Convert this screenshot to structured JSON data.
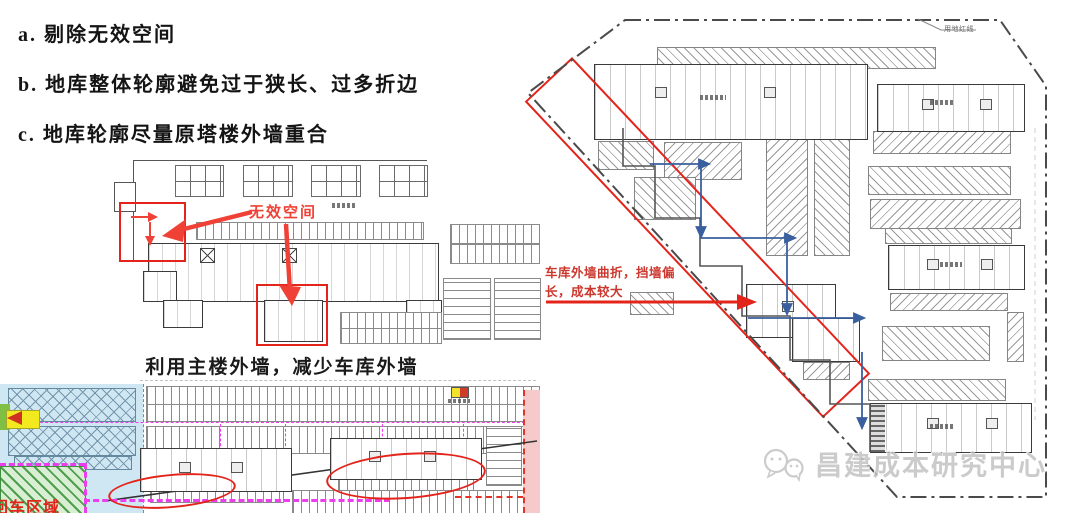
{
  "notes": {
    "a": "a. 剔除无效空间",
    "b": "b. 地库整体轮廓避免过于狭长、过多折边",
    "c": "c. 地库轮廓尽量原塔楼外墙重合"
  },
  "middle_plan": {
    "invalid_space_label": "无效空间",
    "caption": "利用主楼外墙，减少车库外墙"
  },
  "right_plan": {
    "wall_annotation": "车库外墙曲折，挡墙偏长，成本较大",
    "boundary_label": "用地红线"
  },
  "bottom_plan": {
    "corner_label": "回车区域"
  },
  "watermark": {
    "text": "昌建成本研究中心"
  },
  "colors": {
    "annotation_red": "#e3241b",
    "label_red": "#ef4136",
    "magenta_dashed": "#ee3dee",
    "blue_zone": "#cfe7f3",
    "green_zone": "#d9efd4",
    "pink_zone": "#f6caca",
    "arrow_blue": "#3a5f9e",
    "arrow_yellow": "#f2ea1e",
    "watermark_gray": "#c2c2c2"
  }
}
